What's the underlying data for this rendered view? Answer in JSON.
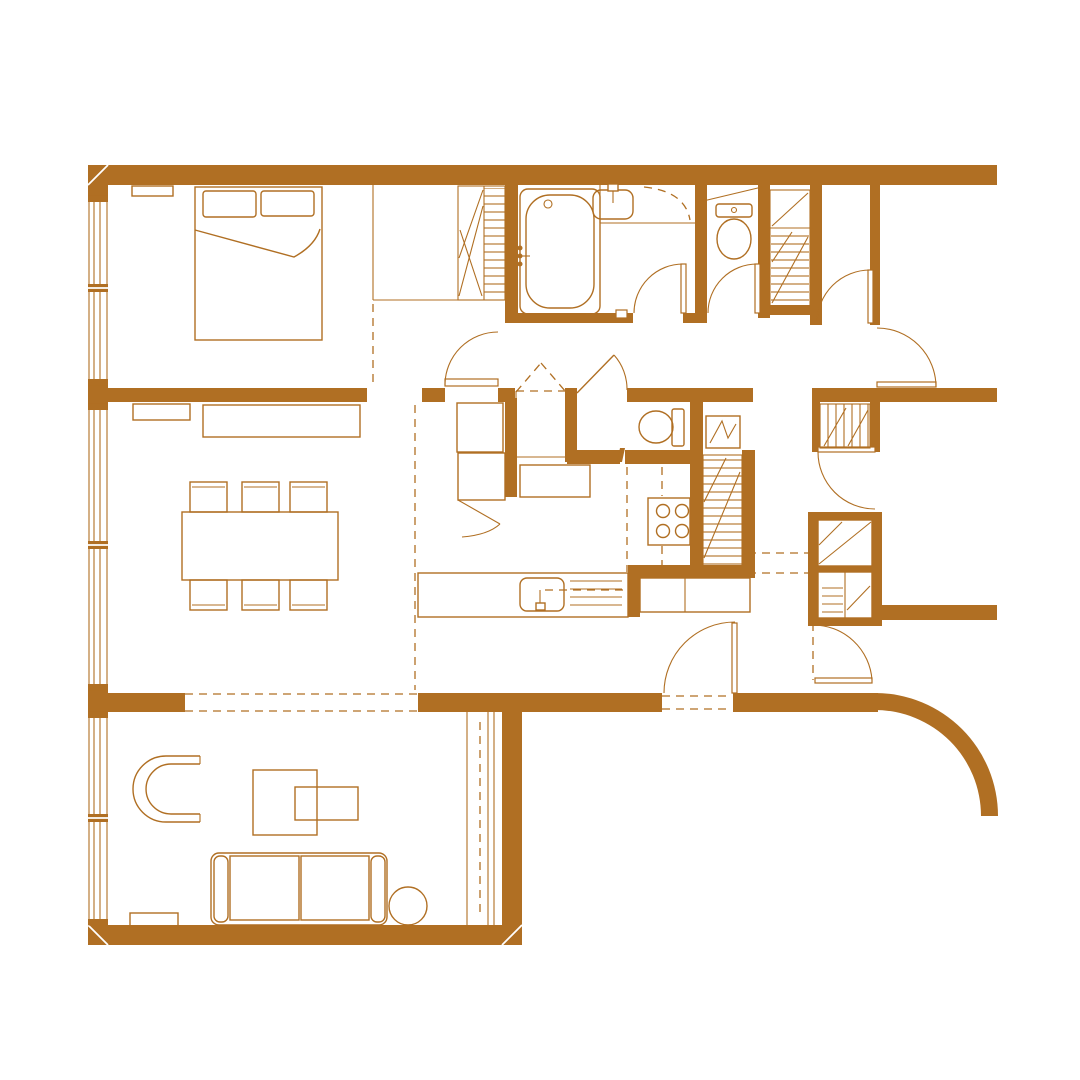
{
  "meta": {
    "title": "Apartment floor plan drawing",
    "canvas": {
      "width": 1080,
      "height": 1080
    }
  },
  "colors": {
    "background": "#ffffff",
    "ink": "#b06f23"
  },
  "plan": {
    "style": "monochrome architectural line drawing, sienna on white",
    "window_count": 3,
    "door_swing_count": 10,
    "rooms": [
      {
        "name": "bedroom",
        "fixtures": [
          "double-bed",
          "two-pillows",
          "duvet-fold",
          "wall-shelf",
          "built-in-closet",
          "hatched-wardrobe",
          "window"
        ]
      },
      {
        "name": "bathroom",
        "fixtures": [
          "bathtub",
          "bath-faucet",
          "vanity-counter",
          "wash-basin",
          "basin-faucet",
          "corner-shelf-dashed",
          "hinged-door"
        ]
      },
      {
        "name": "wc",
        "fixtures": [
          "toilet",
          "sloped-niche",
          "hinged-door"
        ]
      },
      {
        "name": "service-shaft",
        "fixtures": [
          "hatched-duct",
          "diagonal-void"
        ]
      },
      {
        "name": "entrance-vestibule",
        "fixtures": [
          "entrance-door-swing",
          "inner-door-swing"
        ]
      },
      {
        "name": "living-dining-room",
        "fixtures": [
          "dining-table",
          "six-dining-chairs",
          "sideboard",
          "wall-shelf",
          "window",
          "sliding-partition-dashed"
        ]
      },
      {
        "name": "kitchen",
        "fixtures": [
          "island-counter",
          "kitchen-sink",
          "sink-faucet",
          "drainboard-lines",
          "cooktop-4-burners",
          "tall-cabinets",
          "pantry-cabinet",
          "counter-run",
          "refrigerator-hatched"
        ]
      },
      {
        "name": "powder-room",
        "fixtures": [
          "toilet",
          "water-heater",
          "outswing-door"
        ]
      },
      {
        "name": "hallway",
        "fixtures": [
          "hatched-closet",
          "storage-closet-pair",
          "two-door-swings",
          "dashed-reference-lines"
        ]
      },
      {
        "name": "lounge",
        "fixtures": [
          "sofa",
          "armchair",
          "coffee-table-pair",
          "round-side-table",
          "low-bench",
          "window",
          "pocket-slider-dashed"
        ]
      },
      {
        "name": "terrace-edge",
        "fixtures": [
          "curved-wall-quarter-arc"
        ]
      }
    ]
  }
}
